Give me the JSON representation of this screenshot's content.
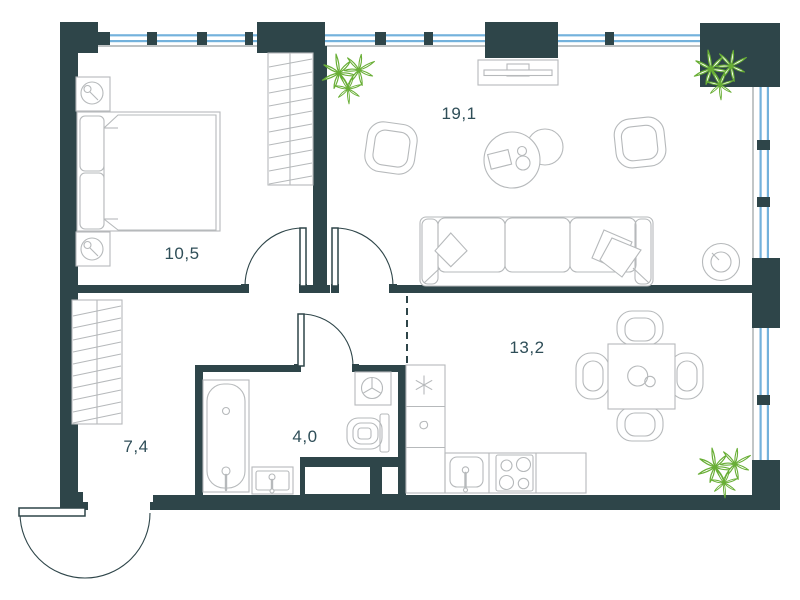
{
  "floor_plan": {
    "rooms": {
      "bedroom": {
        "label": "10,5"
      },
      "living_room": {
        "label": "19,1"
      },
      "kitchen_dining": {
        "label": "13,2"
      },
      "hallway": {
        "label": "7,4"
      },
      "bathroom": {
        "label": "4,0"
      }
    },
    "colors": {
      "wall": "#2e4549",
      "glass": "#74b2dc",
      "furniture": "#b6b9bb",
      "inner_edge": "#a9adaf",
      "plant": "#68ae35",
      "label": "#2f4e58",
      "background": "#ffffff"
    },
    "icons": [
      "plant-icon",
      "asterisk-icon",
      "drop-icon",
      "washing-machine-icon"
    ]
  }
}
